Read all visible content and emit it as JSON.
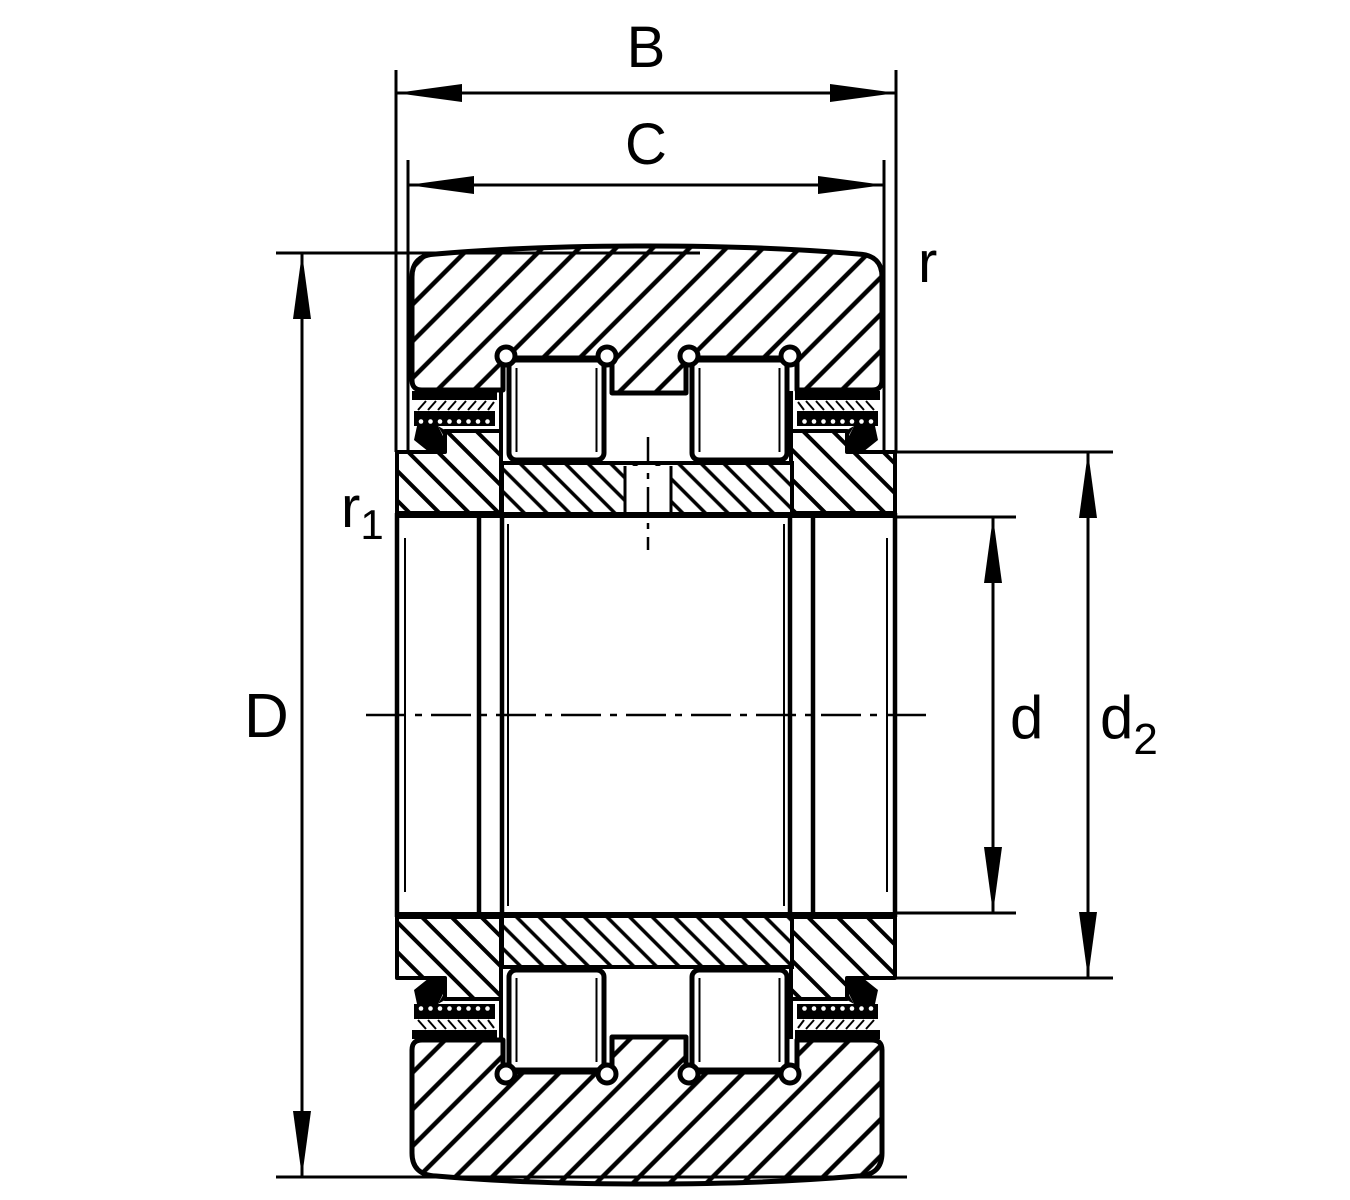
{
  "drawing": {
    "background": "#ffffff",
    "line_color": "#000000",
    "labels": {
      "B": {
        "text": "B"
      },
      "C": {
        "text": "C"
      },
      "D": {
        "text": "D"
      },
      "d": {
        "text": "d"
      },
      "d2": {
        "text": "d",
        "sub": "2"
      },
      "r": {
        "text": "r"
      },
      "r1": {
        "text": "r",
        "sub": "1"
      }
    }
  }
}
